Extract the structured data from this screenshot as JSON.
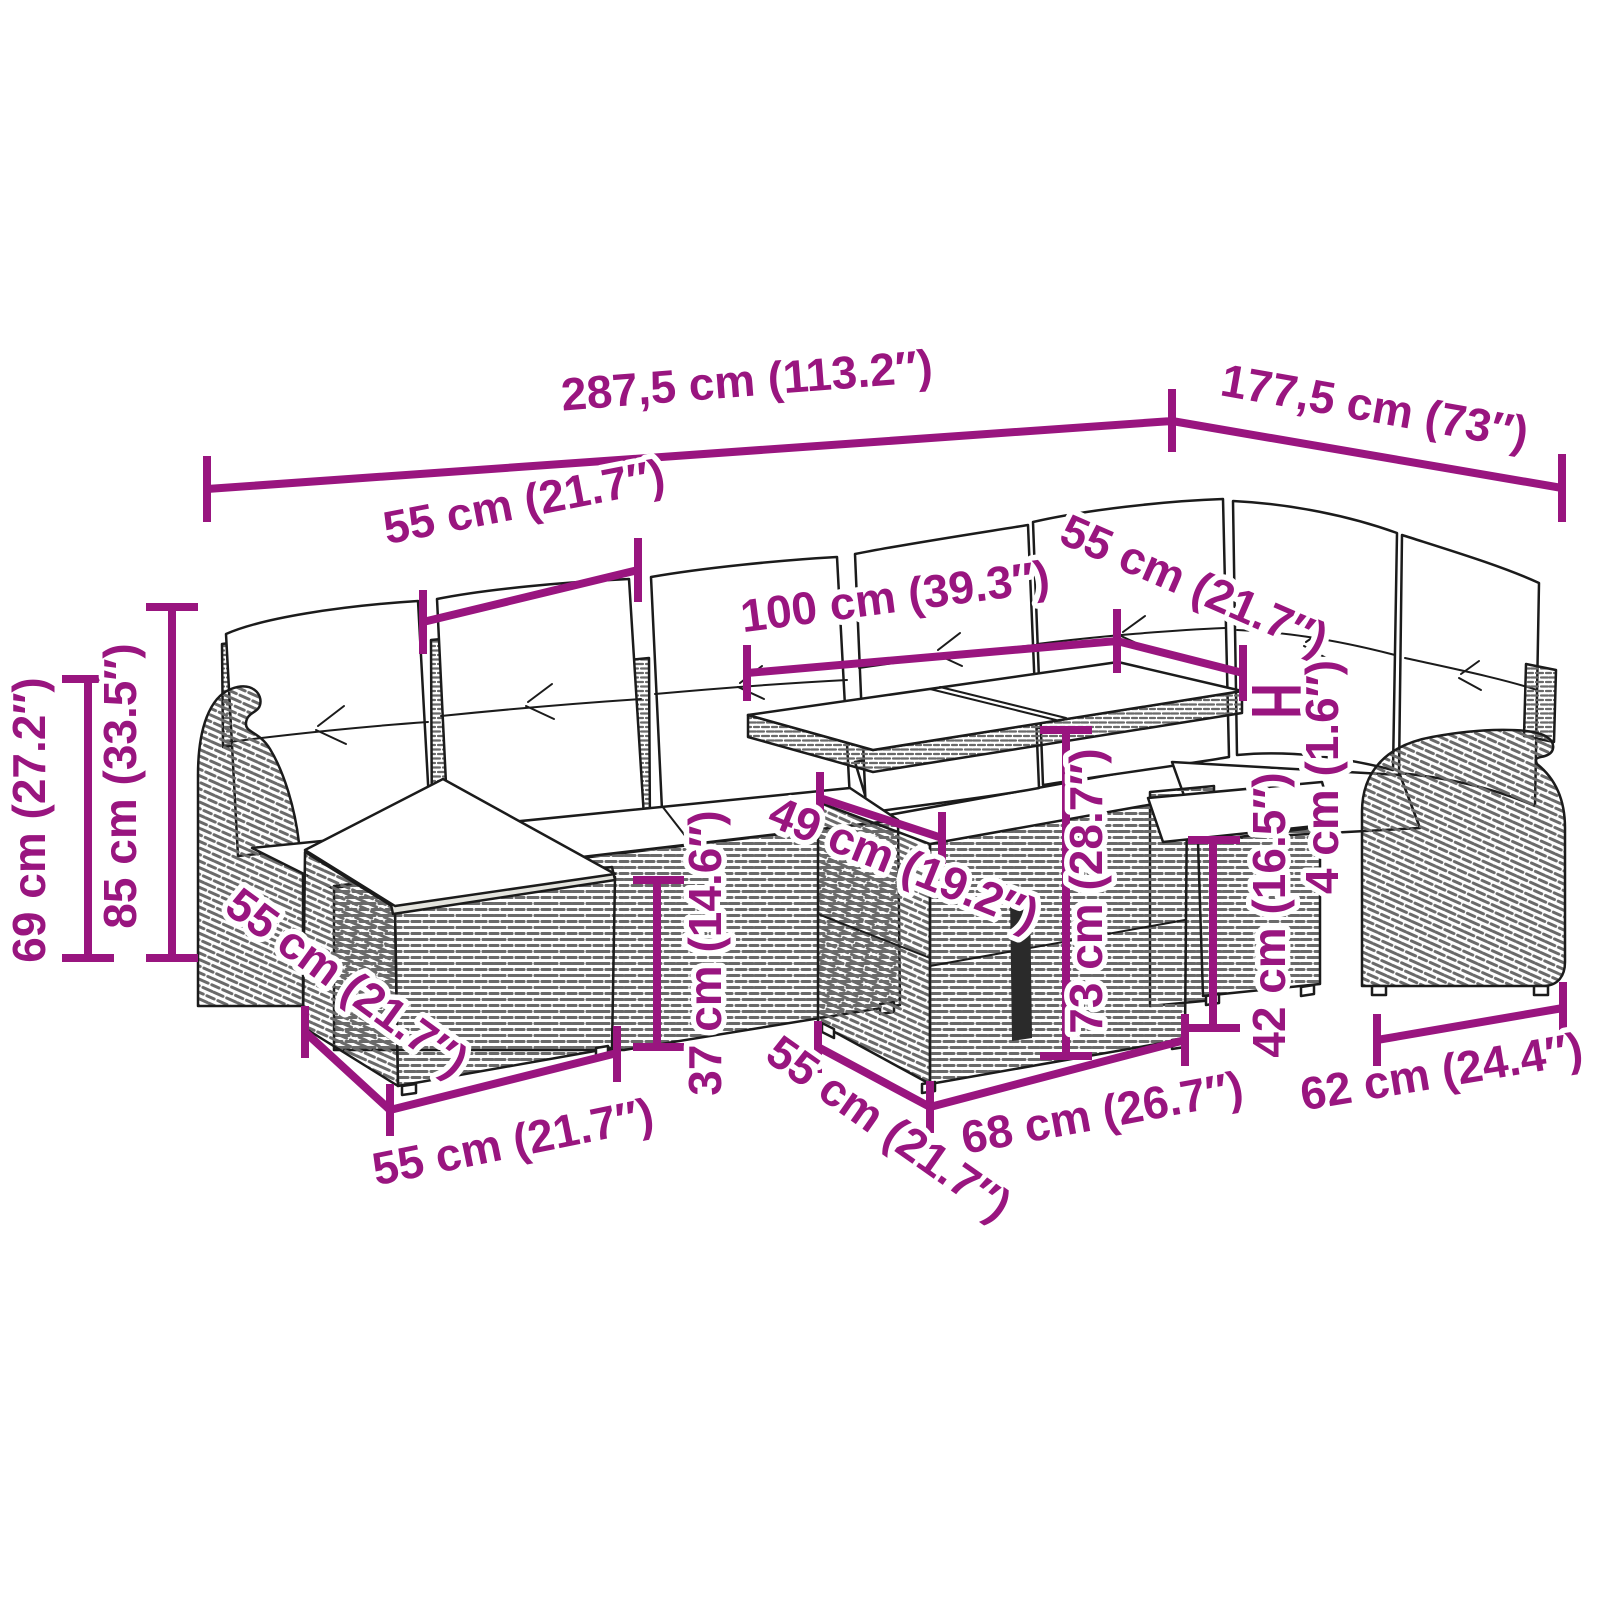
{
  "drawing": {
    "subject": "poly-rattan-garden-lounge-set-line-art",
    "parts": [
      "corner-sofa",
      "back-cushions",
      "seat-cushions",
      "ottoman",
      "glass-top-table",
      "stool",
      "armchair"
    ]
  },
  "colors": {
    "accent": "#99157F",
    "line": "#1b1b1b",
    "background": "#ffffff"
  },
  "measurements": {
    "overall_width": {
      "label": "287,5 cm (113.2″)",
      "cm": 287.5,
      "inches": 113.2
    },
    "overall_depth": {
      "label": "177,5 cm (73″)",
      "cm": 177.5,
      "inches": 73
    },
    "seat_width_left": {
      "label": "55 cm (21.7″)",
      "cm": 55,
      "inches": 21.7
    },
    "table_length": {
      "label": "100 cm (39.3″)",
      "cm": 100,
      "inches": 39.3
    },
    "seat_width_right": {
      "label": "55 cm (21.7″)",
      "cm": 55,
      "inches": 21.7
    },
    "seat_back_height": {
      "label": "69 cm (27.2″)",
      "cm": 69,
      "inches": 27.2
    },
    "total_height": {
      "label": "85 cm (33.5″)",
      "cm": 85,
      "inches": 33.5
    },
    "ottoman_depth": {
      "label": "55 cm (21.7″)",
      "cm": 55,
      "inches": 21.7
    },
    "ottoman_width": {
      "label": "55 cm (21.7″)",
      "cm": 55,
      "inches": 21.7
    },
    "ottoman_height": {
      "label": "37 cm (14.6″)",
      "cm": 37,
      "inches": 14.6
    },
    "table_base_depth": {
      "label": "49 cm (19.2″)",
      "cm": 49,
      "inches": 19.2
    },
    "table_height": {
      "label": "73 cm (28.7″)",
      "cm": 73,
      "inches": 28.7
    },
    "table_bottom_depth": {
      "label": "55 cm (21.7″)",
      "cm": 55,
      "inches": 21.7
    },
    "table_base_width": {
      "label": "68 cm (26.7″)",
      "cm": 68,
      "inches": 26.7
    },
    "stool_height": {
      "label": "42 cm (16.5″)",
      "cm": 42,
      "inches": 16.5
    },
    "tabletop_thickness": {
      "label": "4 cm (1.6″)",
      "cm": 4,
      "inches": 1.6
    },
    "armchair_width": {
      "label": "62 cm (24.4″)",
      "cm": 62,
      "inches": 24.4
    }
  }
}
